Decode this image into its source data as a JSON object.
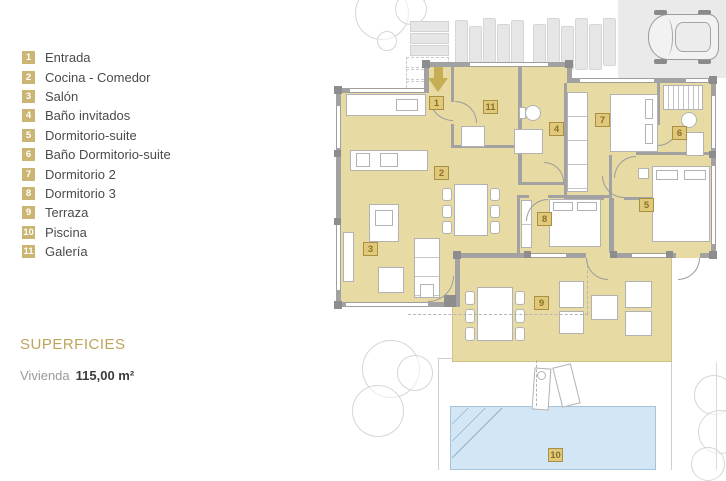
{
  "legend": {
    "items": [
      {
        "num": "1",
        "label": "Entrada"
      },
      {
        "num": "2",
        "label": "Cocina - Comedor"
      },
      {
        "num": "3",
        "label": "Salón"
      },
      {
        "num": "4",
        "label": "Baño invitados"
      },
      {
        "num": "5",
        "label": "Dormitorio-suite"
      },
      {
        "num": "6",
        "label": "Baño Dormitorio-suite"
      },
      {
        "num": "7",
        "label": "Dormitorio 2"
      },
      {
        "num": "8",
        "label": "Dormitorio 3"
      },
      {
        "num": "9",
        "label": "Terraza"
      },
      {
        "num": "10",
        "label": "Piscina"
      },
      {
        "num": "11",
        "label": "Galería"
      }
    ]
  },
  "superficies": {
    "title": "SUPERFICIES",
    "area_label": "Vivienda",
    "area_value": "115,00 m²"
  },
  "plan": {
    "room_badges": [
      {
        "num": "1",
        "x": 429,
        "y": 96
      },
      {
        "num": "2",
        "x": 434,
        "y": 166
      },
      {
        "num": "3",
        "x": 363,
        "y": 242
      },
      {
        "num": "4",
        "x": 549,
        "y": 122
      },
      {
        "num": "5",
        "x": 639,
        "y": 198
      },
      {
        "num": "6",
        "x": 672,
        "y": 126
      },
      {
        "num": "7",
        "x": 595,
        "y": 113
      },
      {
        "num": "8",
        "x": 537,
        "y": 212
      },
      {
        "num": "9",
        "x": 534,
        "y": 296
      },
      {
        "num": "10",
        "x": 548,
        "y": 448
      },
      {
        "num": "11",
        "x": 483,
        "y": 100
      }
    ],
    "colors": {
      "room_fill": "#e7dba3",
      "wall": "#a2a2a2",
      "pool": "#d2e6f5",
      "accent_gold": "#c7ae55",
      "legend_badge": "#cbb573"
    }
  }
}
